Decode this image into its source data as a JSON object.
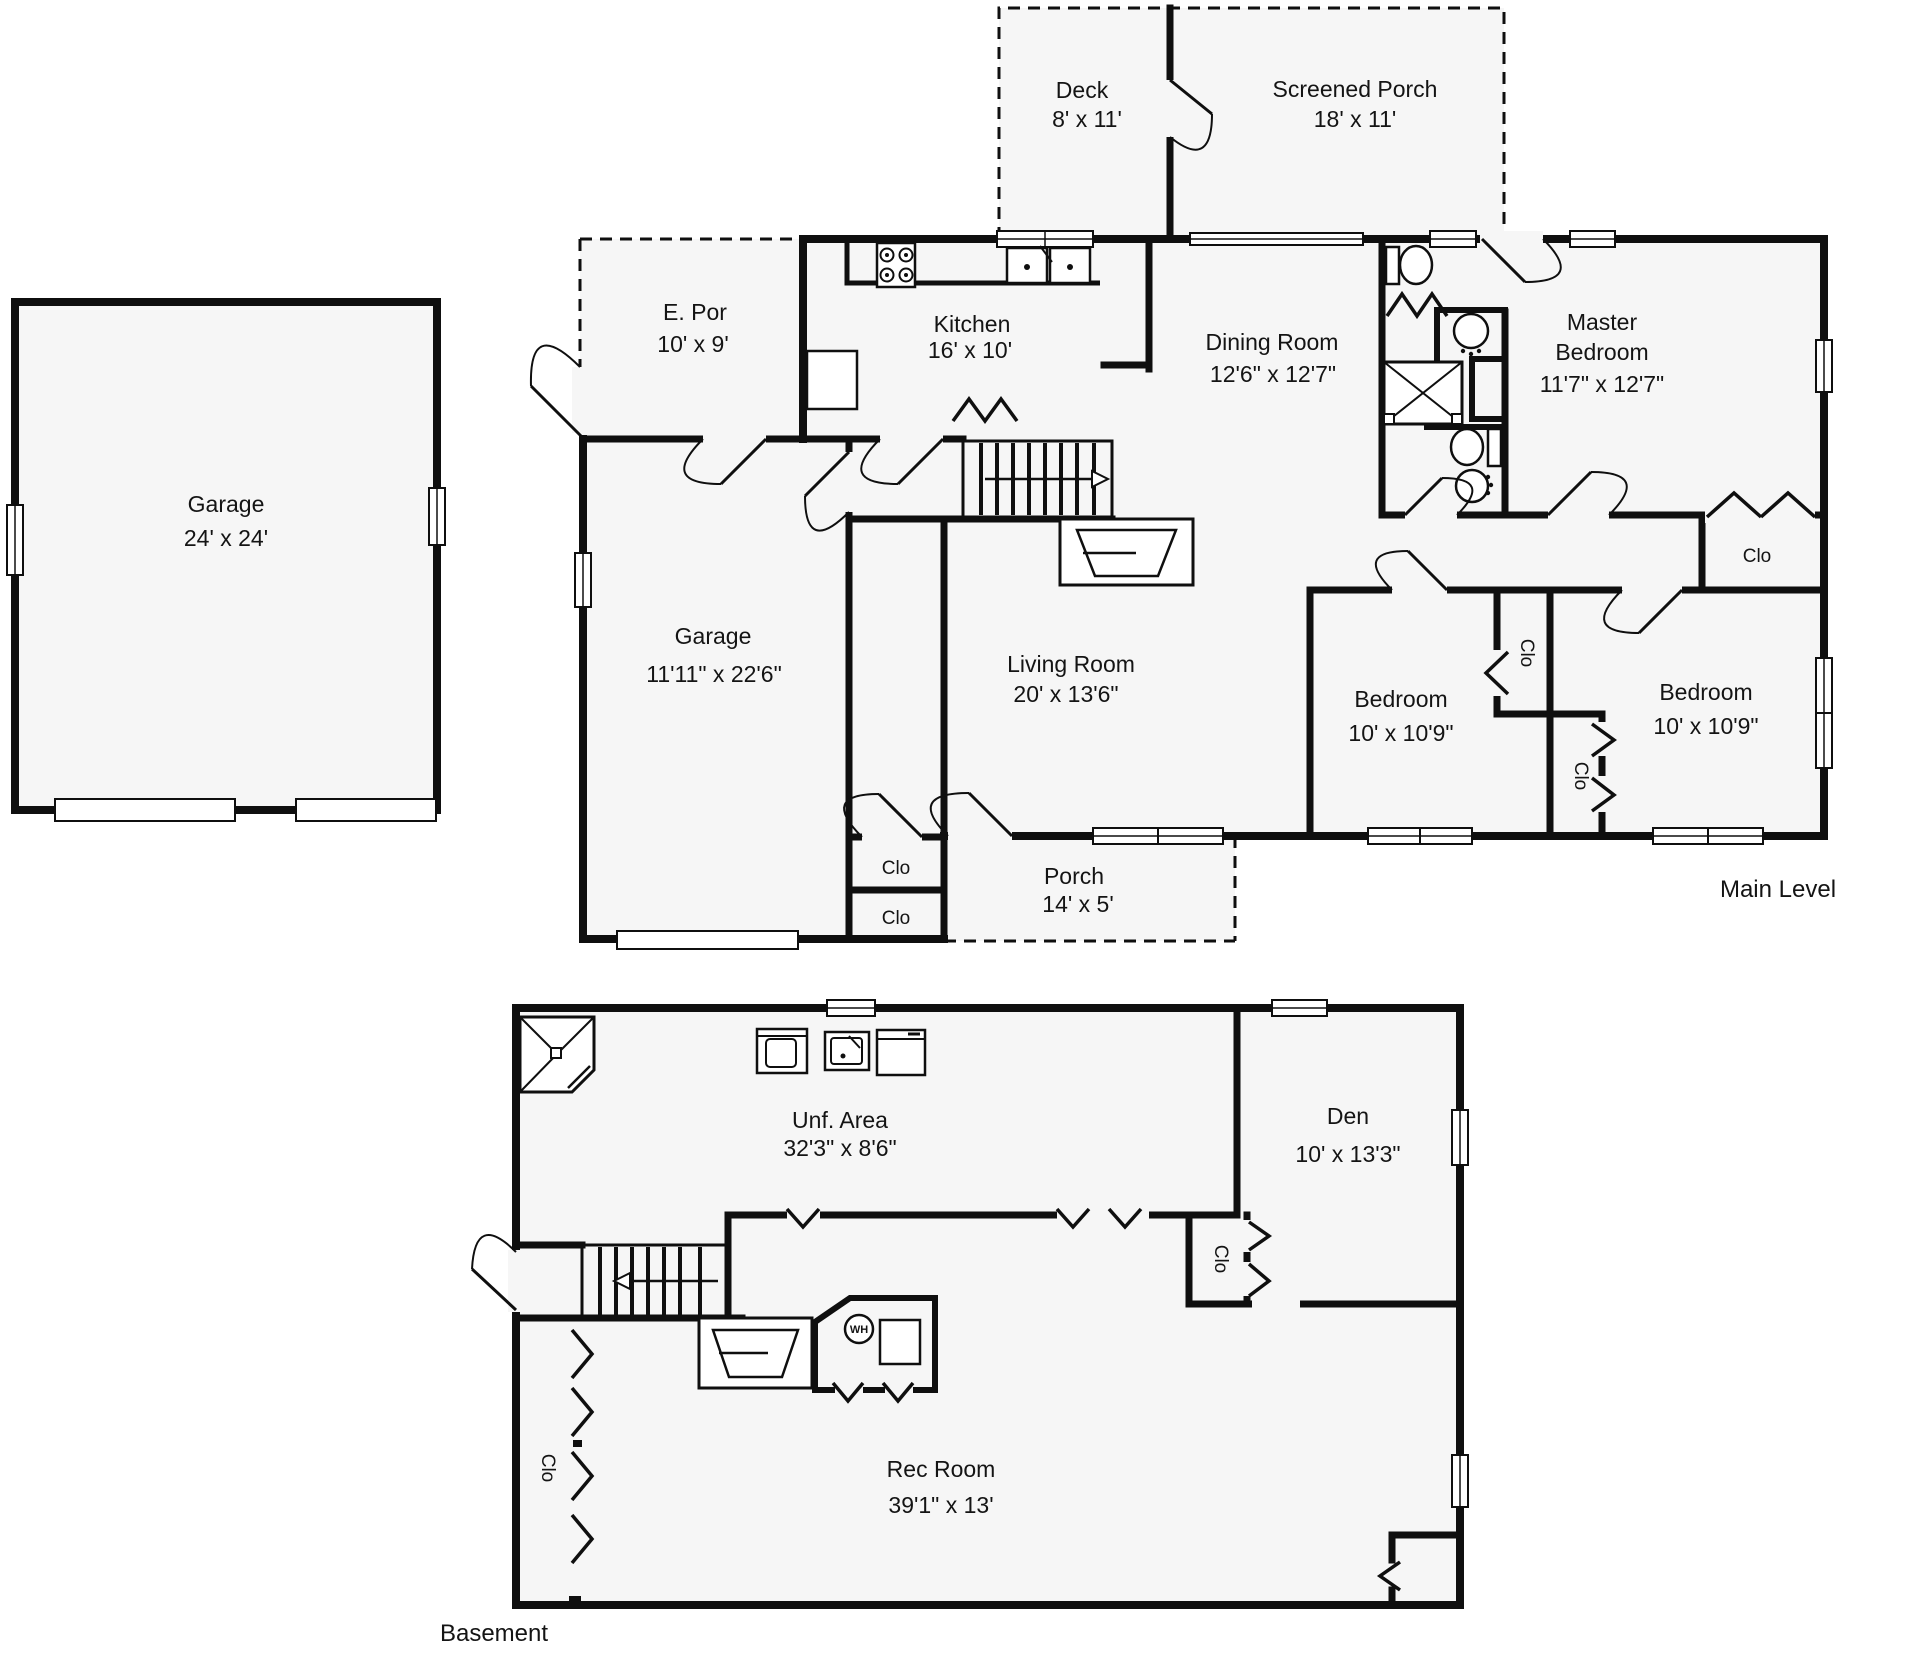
{
  "colors": {
    "wall": "#0f0f0f",
    "floor": "#f6f6f6",
    "background": "#ffffff"
  },
  "main": {
    "caption": "Main Level",
    "rooms": {
      "deck": {
        "name": "Deck",
        "dims": "8' x 11'"
      },
      "screened_porch": {
        "name": "Screened Porch",
        "dims": "18' x 11'"
      },
      "e_por": {
        "name": "E. Por",
        "dims": "10' x 9'"
      },
      "kitchen": {
        "name": "Kitchen",
        "dims": "16' x 10'"
      },
      "dining": {
        "name": "Dining Room",
        "dims": "12'6\" x 12'7\""
      },
      "master": {
        "name1": "Master",
        "name2": "Bedroom",
        "dims": "11'7\" x 12'7\""
      },
      "garage_detached": {
        "name": "Garage",
        "dims": "24' x 24'"
      },
      "garage_attached": {
        "name": "Garage",
        "dims": "11'11\" x 22'6\""
      },
      "living": {
        "name": "Living Room",
        "dims": "20' x 13'6\""
      },
      "bedroom1": {
        "name": "Bedroom",
        "dims": "10' x 10'9\""
      },
      "bedroom2": {
        "name": "Bedroom",
        "dims": "10' x 10'9\""
      },
      "porch": {
        "name": "Porch",
        "dims": "14' x 5'"
      }
    },
    "closet_label": "Clo"
  },
  "basement": {
    "caption": "Basement",
    "rooms": {
      "unf_area": {
        "name": "Unf. Area",
        "dims": "32'3\" x 8'6\""
      },
      "den": {
        "name": "Den",
        "dims": "10' x 13'3\""
      },
      "rec_room": {
        "name": "Rec Room",
        "dims": "39'1\" x 13'"
      }
    },
    "closet_label": "Clo",
    "water_heater_label": "WH"
  }
}
